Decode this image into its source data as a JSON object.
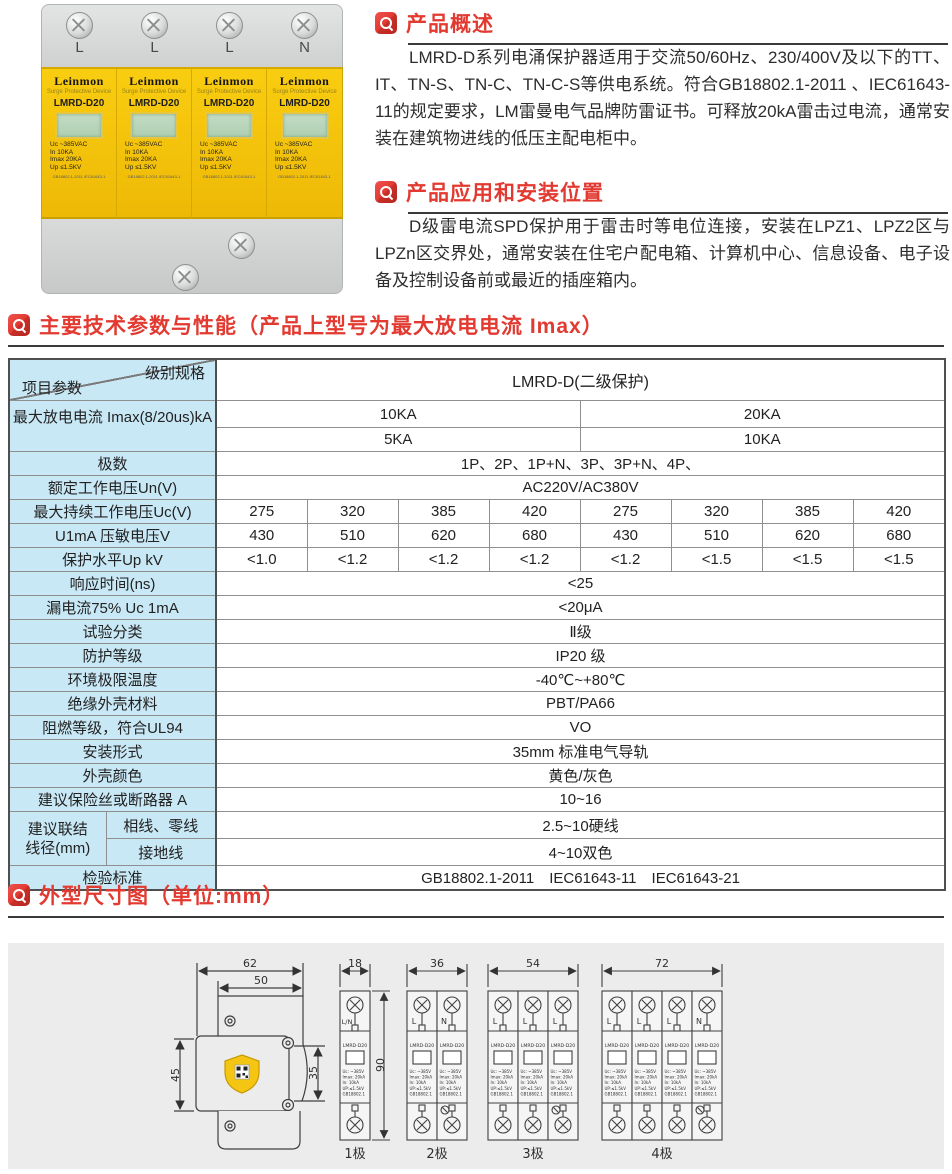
{
  "colors": {
    "accent_red": "#e23a31",
    "table_blue": "#c9e8f6",
    "panel_gray": "#ececec",
    "module_yellow": "#f3c50e",
    "line_dark": "#3a3a3a"
  },
  "photo": {
    "terminals": [
      "L",
      "L",
      "L",
      "N"
    ],
    "module": {
      "brand": "Leinmon",
      "subtitle": "Surge Protective Device",
      "model": "LMRD-D20",
      "specs": [
        "Uc  ~385VAC",
        "In      10KA",
        "Imax  20KA",
        "Up ≤1.5KV"
      ],
      "cert": "GB18802.1-2011 IEC61643-1"
    }
  },
  "sections": {
    "overview": {
      "title": "产品概述",
      "body": "LMRD-D系列电涌保护器适用于交流50/60Hz、230/400V及以下的TT、IT、TN-S、TN-C、TN-C-S等供电系统。符合GB18802.1-2011 、IEC61643-11的规定要求，LM雷曼电气品牌防雷证书。可释放20kA雷击过电流，通常安装在建筑物进线的低压主配电柜中。"
    },
    "application": {
      "title": "产品应用和安装位置",
      "body": "D级雷电流SPD保护用于雷击时等电位连接，安装在LPZ1、LPZ2区与LPZn区交界处，通常安装在住宅户配电箱、计算机中心、信息设备、电子设备及控制设备前或最近的插座箱内。"
    },
    "parameters": {
      "title": "主要技术参数与性能（产品上型号为最大放电电流 Imax）"
    },
    "dimensions": {
      "title": "外型尺寸图（单位:mm）"
    }
  },
  "table": {
    "corner": {
      "top": "级别规格",
      "bottom": "项目参数"
    },
    "product_header": "LMRD-D(二级保护)",
    "imax": {
      "label": "最大放电电流 Imax(8/20us)kA",
      "row1": [
        "10KA",
        "20KA"
      ],
      "row2": [
        "5KA",
        "10KA"
      ]
    },
    "poles": {
      "label": "极数",
      "value": "1P、2P、1P+N、3P、3P+N、4P、"
    },
    "un": {
      "label": "额定工作电压Un(V)",
      "value": "AC220V/AC380V"
    },
    "uc": {
      "label": "最大持续工作电压Uc(V)",
      "values": [
        "275",
        "320",
        "385",
        "420",
        "275",
        "320",
        "385",
        "420"
      ]
    },
    "u1ma": {
      "label": "U1mA 压敏电压V",
      "values": [
        "430",
        "510",
        "620",
        "680",
        "430",
        "510",
        "620",
        "680"
      ]
    },
    "up": {
      "label": "保护水平Up kV",
      "values": [
        "<1.0",
        "<1.2",
        "<1.2",
        "<1.2",
        "<1.2",
        "<1.5",
        "<1.5",
        "<1.5"
      ]
    },
    "simple_rows": [
      {
        "label": "响应时间(ns)",
        "value": "<25"
      },
      {
        "label": "漏电流75% Uc 1mA",
        "value": "<20μA"
      },
      {
        "label": "试验分类",
        "value": "Ⅱ级"
      },
      {
        "label": "防护等级",
        "value": "IP20 级"
      },
      {
        "label": "环境极限温度",
        "value": "-40℃~+80℃"
      },
      {
        "label": "绝缘外壳材料",
        "value": "PBT/PA66"
      },
      {
        "label": "阻燃等级，符合UL94",
        "value": "VO"
      },
      {
        "label": "安装形式",
        "value": "35mm 标准电气导轨"
      },
      {
        "label": "外壳颜色",
        "value": "黄色/灰色"
      },
      {
        "label": "建议保险丝或断路器 A",
        "value": "10~16"
      }
    ],
    "wire": {
      "label_line1": "建议联结",
      "label_line2": "线径(mm)",
      "rows": [
        {
          "sub": "相线、零线",
          "value": "2.5~10硬线"
        },
        {
          "sub": "接地线",
          "value": "4~10双色"
        }
      ]
    },
    "standard": {
      "label": "检验标准",
      "value": "GB18802.1-2011　IEC61643-11　IEC61643-21"
    }
  },
  "drawing": {
    "side": {
      "w_outer": "62",
      "w_inner": "50",
      "h_left": "45",
      "h_right": "35"
    },
    "module_text": {
      "model": "LMRD-D20",
      "specs": [
        "Uc: ~385V",
        "Imax: 20kA",
        "In:   10kA",
        "UP:≤1.5kV",
        "GB18802.1"
      ]
    },
    "groups": [
      {
        "dim": "18",
        "h_dim": "90",
        "label": "1极",
        "poles": [
          "L/N"
        ]
      },
      {
        "dim": "36",
        "label": "2极",
        "poles": [
          "L",
          "N"
        ]
      },
      {
        "dim": "54",
        "label": "3极",
        "poles": [
          "L",
          "L",
          "L"
        ]
      },
      {
        "dim": "72",
        "label": "4极",
        "poles": [
          "L",
          "L",
          "L",
          "N"
        ]
      }
    ]
  }
}
